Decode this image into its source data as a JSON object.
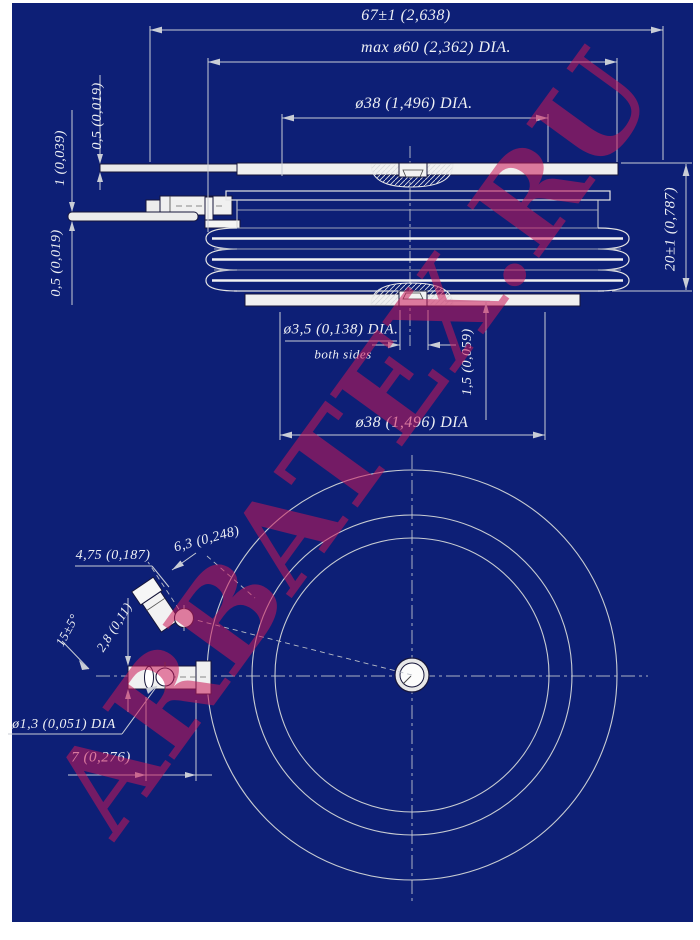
{
  "watermark": {
    "text": "ARBATEX.RU"
  },
  "colors": {
    "background_blue": "#0d1f76",
    "page_white": "#ffffff",
    "dim_line": "#c9cdd6",
    "part_line": "#efefef",
    "text": "#eef0f4",
    "watermark_red": "#cb1858"
  },
  "side_view": {
    "dims": {
      "overall_width": "67±1 (2,638)",
      "max_body_dia": "max ø60 (2,362) DIA.",
      "top_contact_dia": "ø38 (1,496) DIA.",
      "top_lead_thickness": "0,5 (0,019)",
      "gate_lead_thickness": "1 (0,039)",
      "braid_thickness": "0,5 (0,019)",
      "height": "20±1 (0,787)",
      "center_hole_dia": "ø3,5 (0,138) DIA.",
      "center_hole_note": "both sides",
      "recess_depth": "1,5 (0,059)",
      "bottom_contact_dia": "ø38 (1,496) DIA"
    }
  },
  "bottom_view": {
    "dims": {
      "gate_terminal_width": "4,75 (0,187)",
      "gate_terminal_length": "6,3 (0,248)",
      "gate_terminal_angle": "15±5°",
      "terminal_thickness": "2,8 (0,11)",
      "pin_hole_dia": "ø1,3 (0,051) DIA",
      "terminal_offset": "7 (0,276)"
    }
  }
}
